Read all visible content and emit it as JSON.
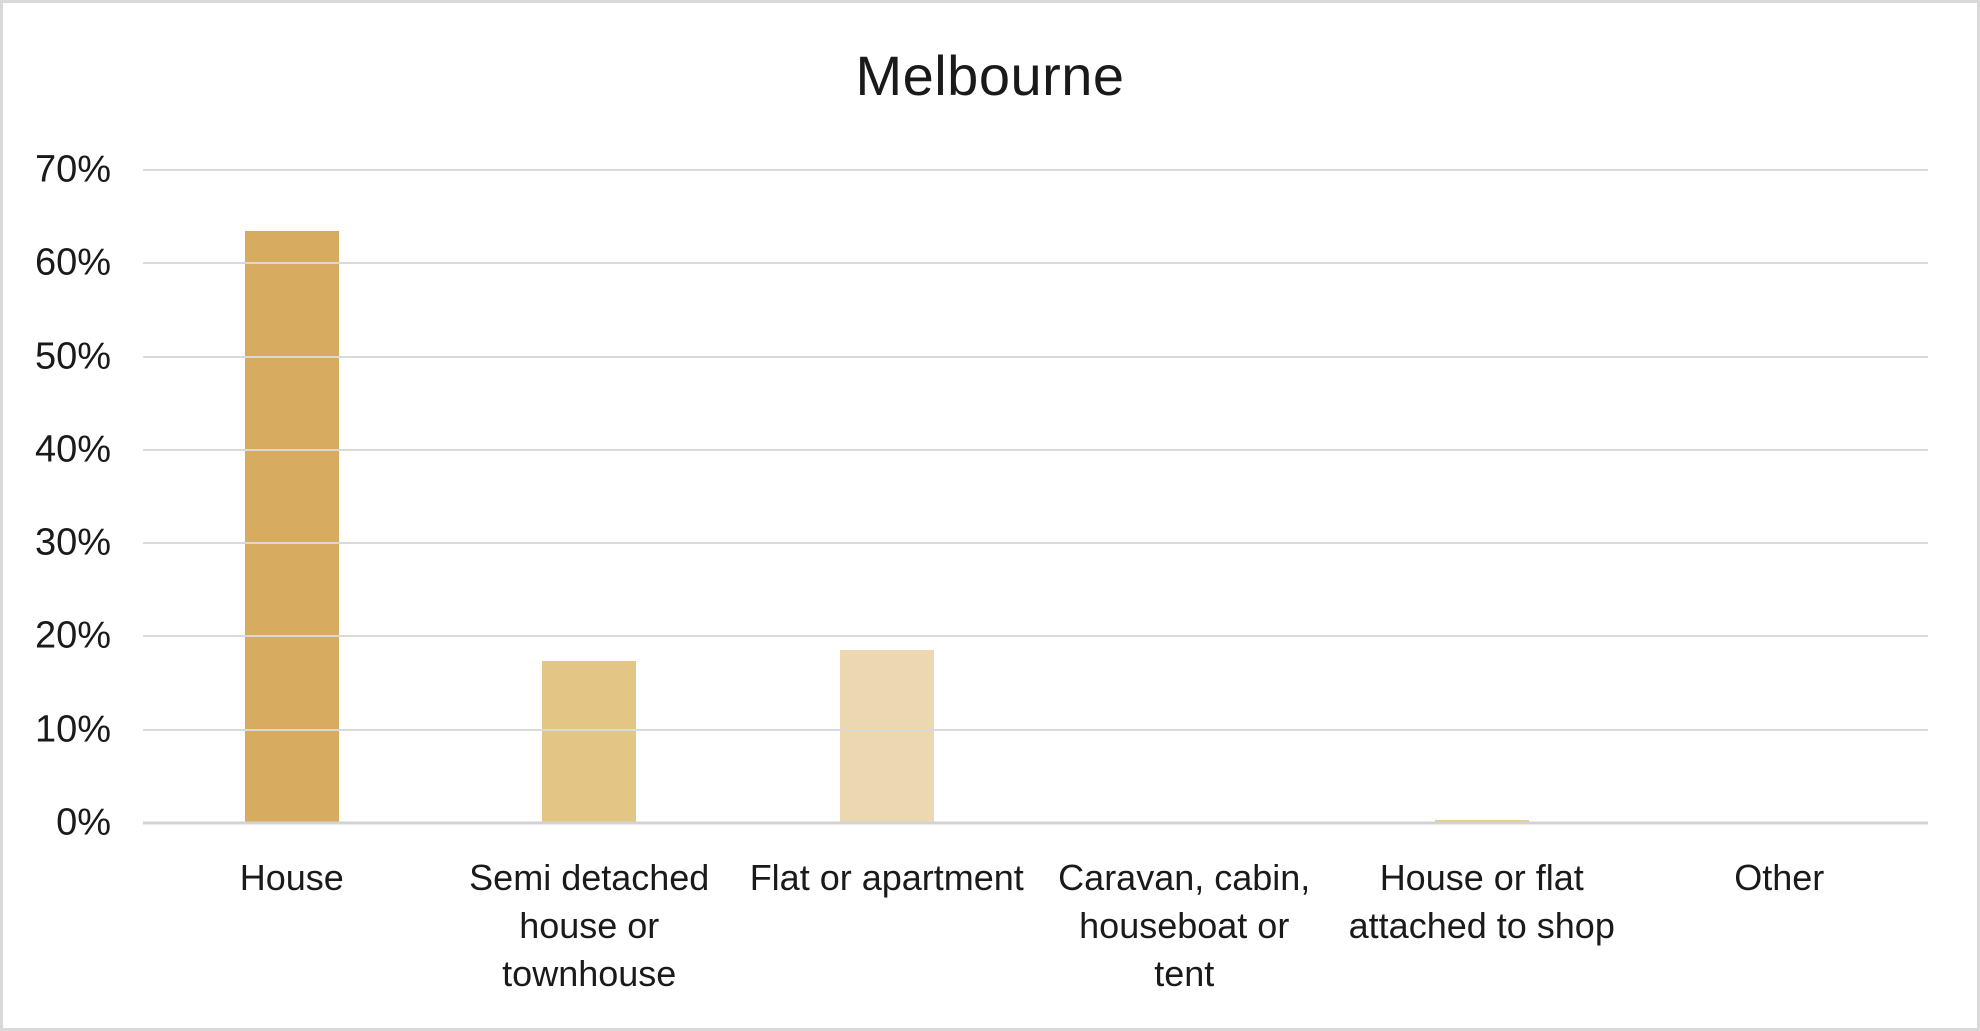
{
  "chart_data": {
    "type": "bar",
    "title": "Melbourne",
    "categories": [
      "House",
      "Semi detached\nhouse or\ntownhouse",
      "Flat or apartment",
      "Caravan, cabin,\nhouseboat or\ntent",
      "House or flat\nattached to shop",
      "Other"
    ],
    "values": [
      63.5,
      17.4,
      18.5,
      0,
      0.3,
      0
    ],
    "value_unit": "%",
    "xlabel": "",
    "ylabel": "",
    "ylim": [
      0,
      70
    ],
    "ytick_step": 10,
    "ytick_labels": [
      "0%",
      "10%",
      "20%",
      "30%",
      "40%",
      "50%",
      "60%",
      "70%"
    ],
    "grid": true,
    "legend": false,
    "bar_colors": [
      "#d8ac60",
      "#e3c586",
      "#ecd8b0",
      "#f0e2c6",
      "#e6cb92",
      "#f0e2c6"
    ],
    "gridline_color": "#d9d9d9",
    "axis_line_color": "#d3d3d3",
    "text_color": "#1a1a1a",
    "frame_border_color": "#d9d9d9",
    "background_color": "#ffffff"
  }
}
